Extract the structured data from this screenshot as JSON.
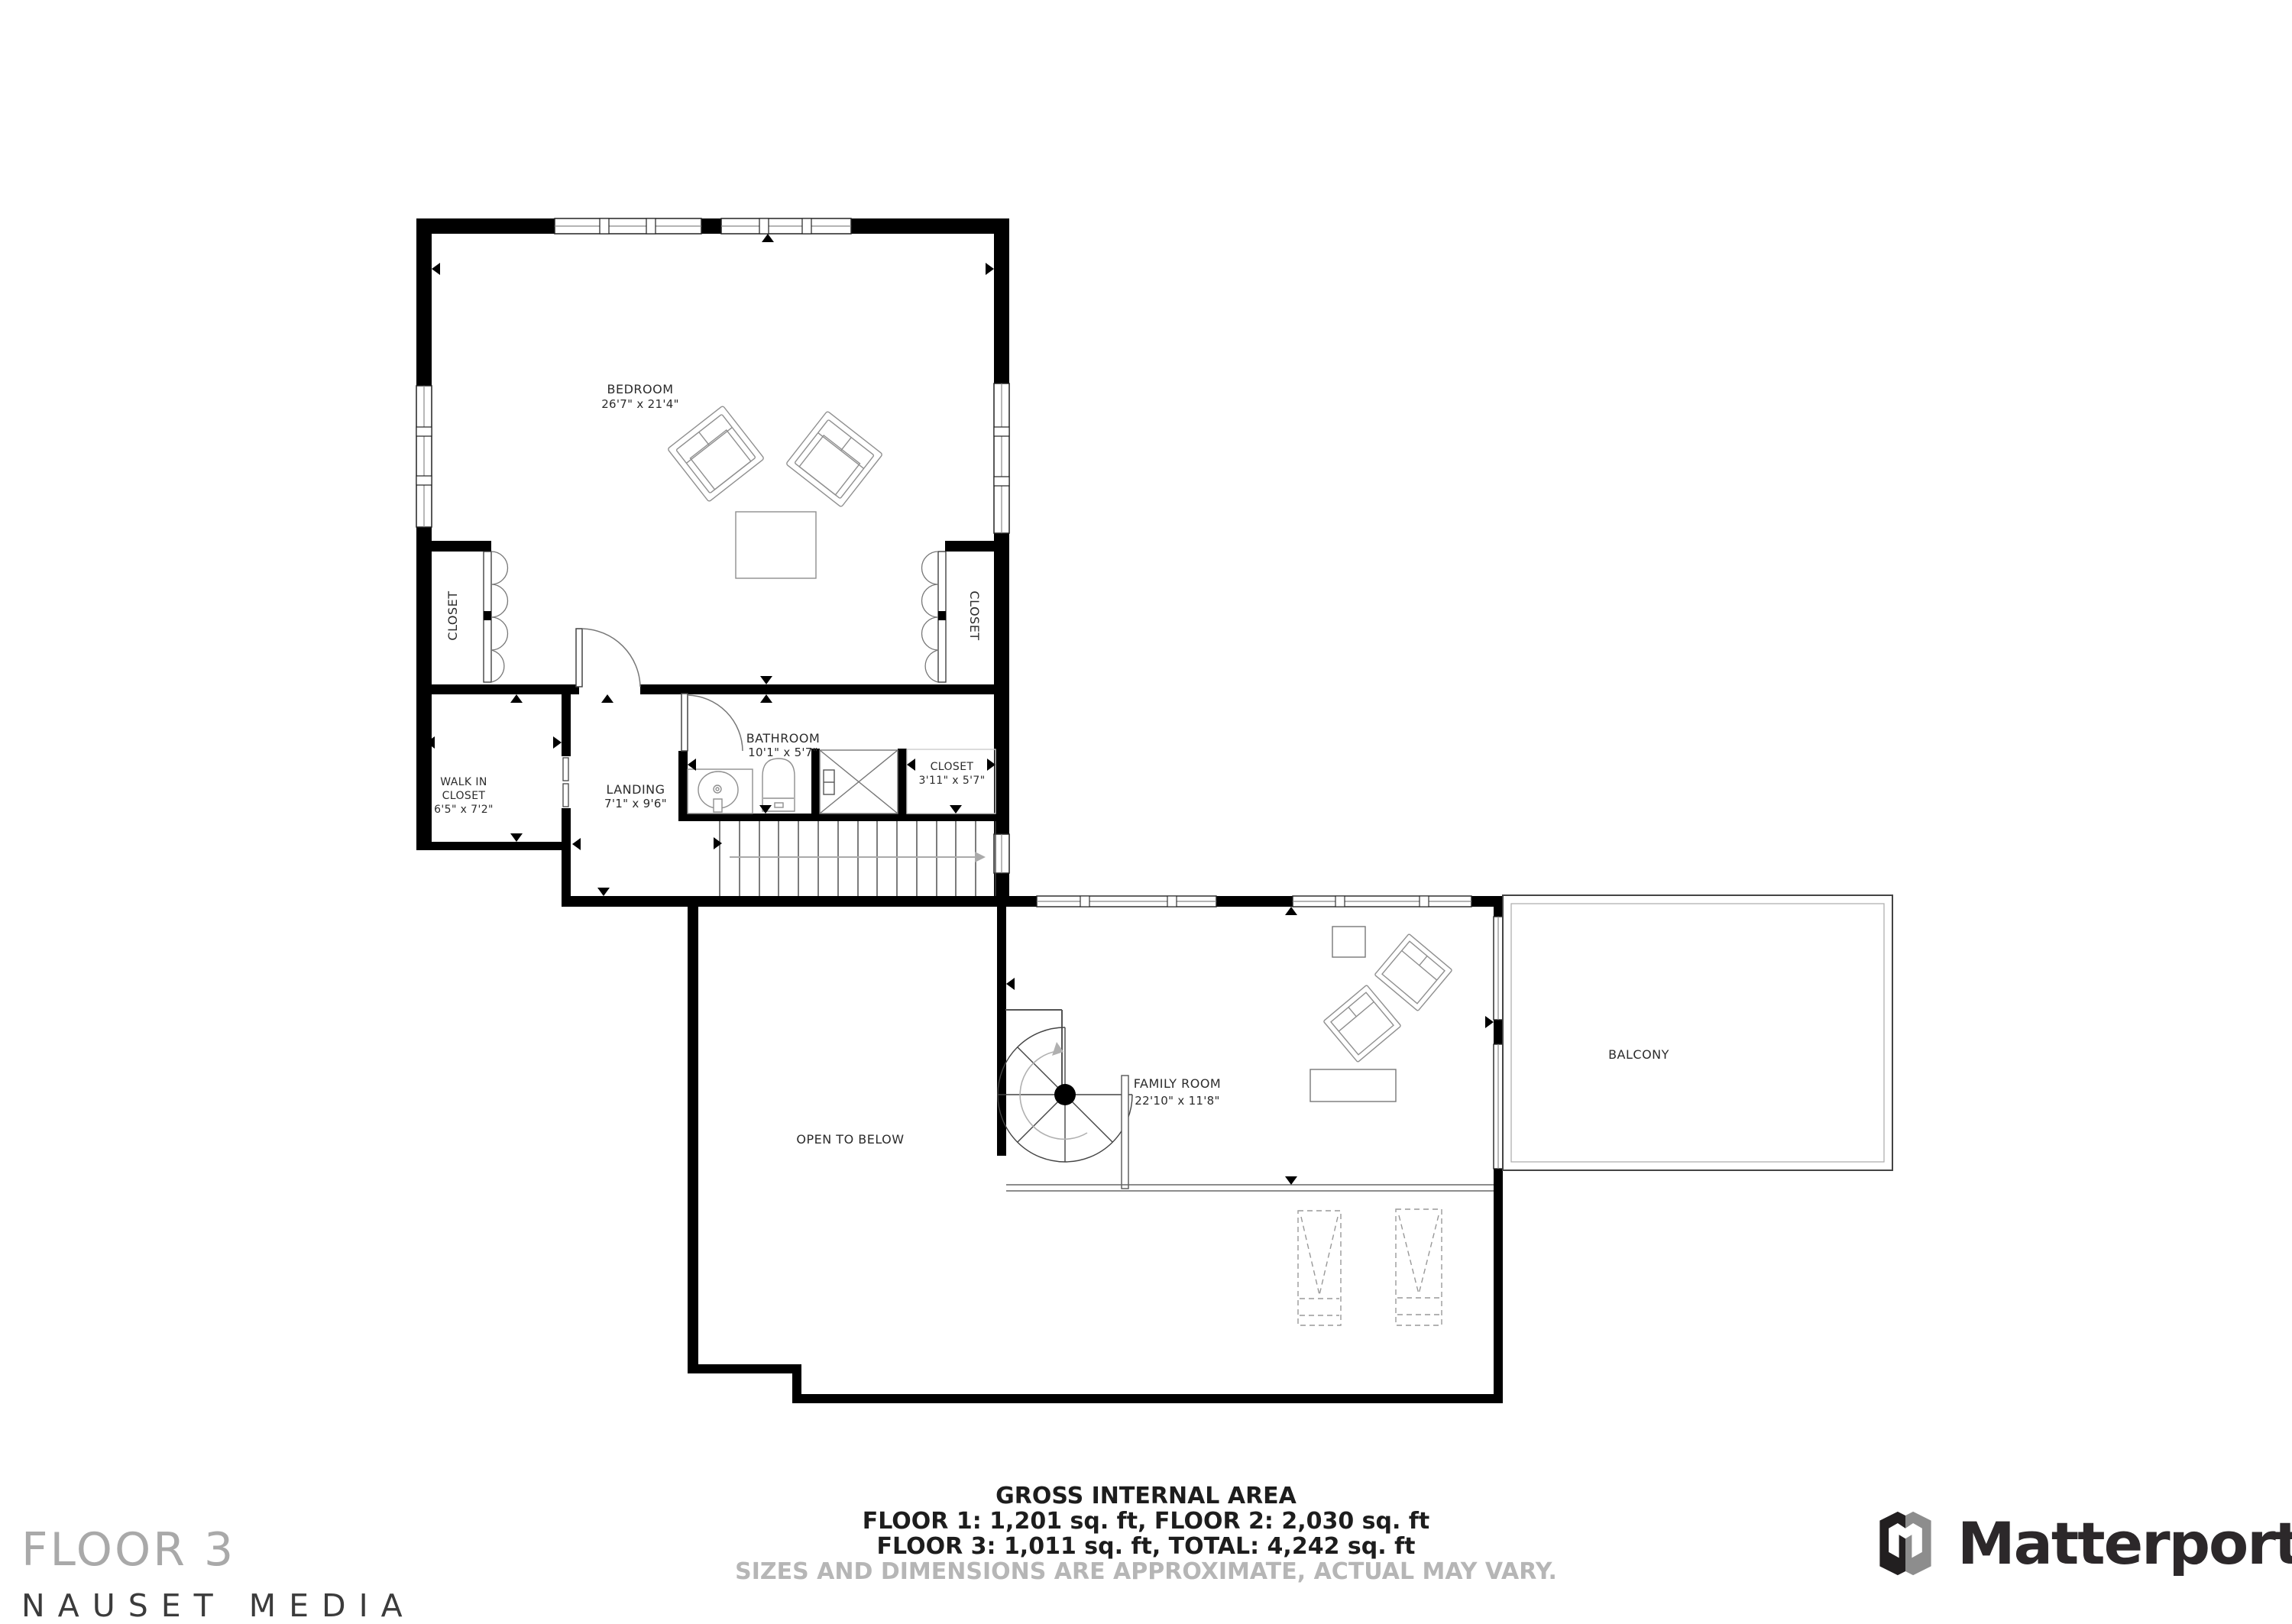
{
  "rooms": {
    "bedroom": {
      "name": "BEDROOM",
      "dims": "26'7\" x 21'4\""
    },
    "closet_left": {
      "name": "CLOSET"
    },
    "closet_right": {
      "name": "CLOSET"
    },
    "walk_in_closet": {
      "line1": "WALK IN",
      "line2": "CLOSET",
      "dims": "6'5\" x 7'2\""
    },
    "landing": {
      "name": "LANDING",
      "dims": "7'1\" x 9'6\""
    },
    "bathroom": {
      "name": "BATHROOM",
      "dims": "10'1\" x 5'7\""
    },
    "closet_small": {
      "name": "CLOSET",
      "dims": "3'11\" x 5'7\""
    },
    "open_to_below": {
      "name": "OPEN TO BELOW"
    },
    "family_room": {
      "name": "FAMILY ROOM",
      "dims": "22'10\" x 11'8\""
    },
    "balcony": {
      "name": "BALCONY"
    }
  },
  "footer": {
    "area_title": "GROSS INTERNAL AREA",
    "area_line1": "FLOOR 1: 1,201 sq. ft, FLOOR 2: 2,030 sq. ft",
    "area_line2": "FLOOR 3: 1,011 sq. ft, TOTAL: 4,242 sq. ft",
    "disclaimer": "SIZES AND DIMENSIONS ARE APPROXIMATE, ACTUAL MAY VARY.",
    "floor_label": "FLOOR 3",
    "company": "NAUSET MEDIA",
    "brand": "Matterport"
  },
  "colors": {
    "wall": "#000000",
    "thin_line": "#555555",
    "furniture_line": "#8f8f8f",
    "label_text": "#2b2b2b",
    "disclaimer_text": "#b6b6b6",
    "floor_label_gray": "#a9a9a9",
    "brand_dark": "#2c282a",
    "logo_gray": "#8d8d8d"
  }
}
